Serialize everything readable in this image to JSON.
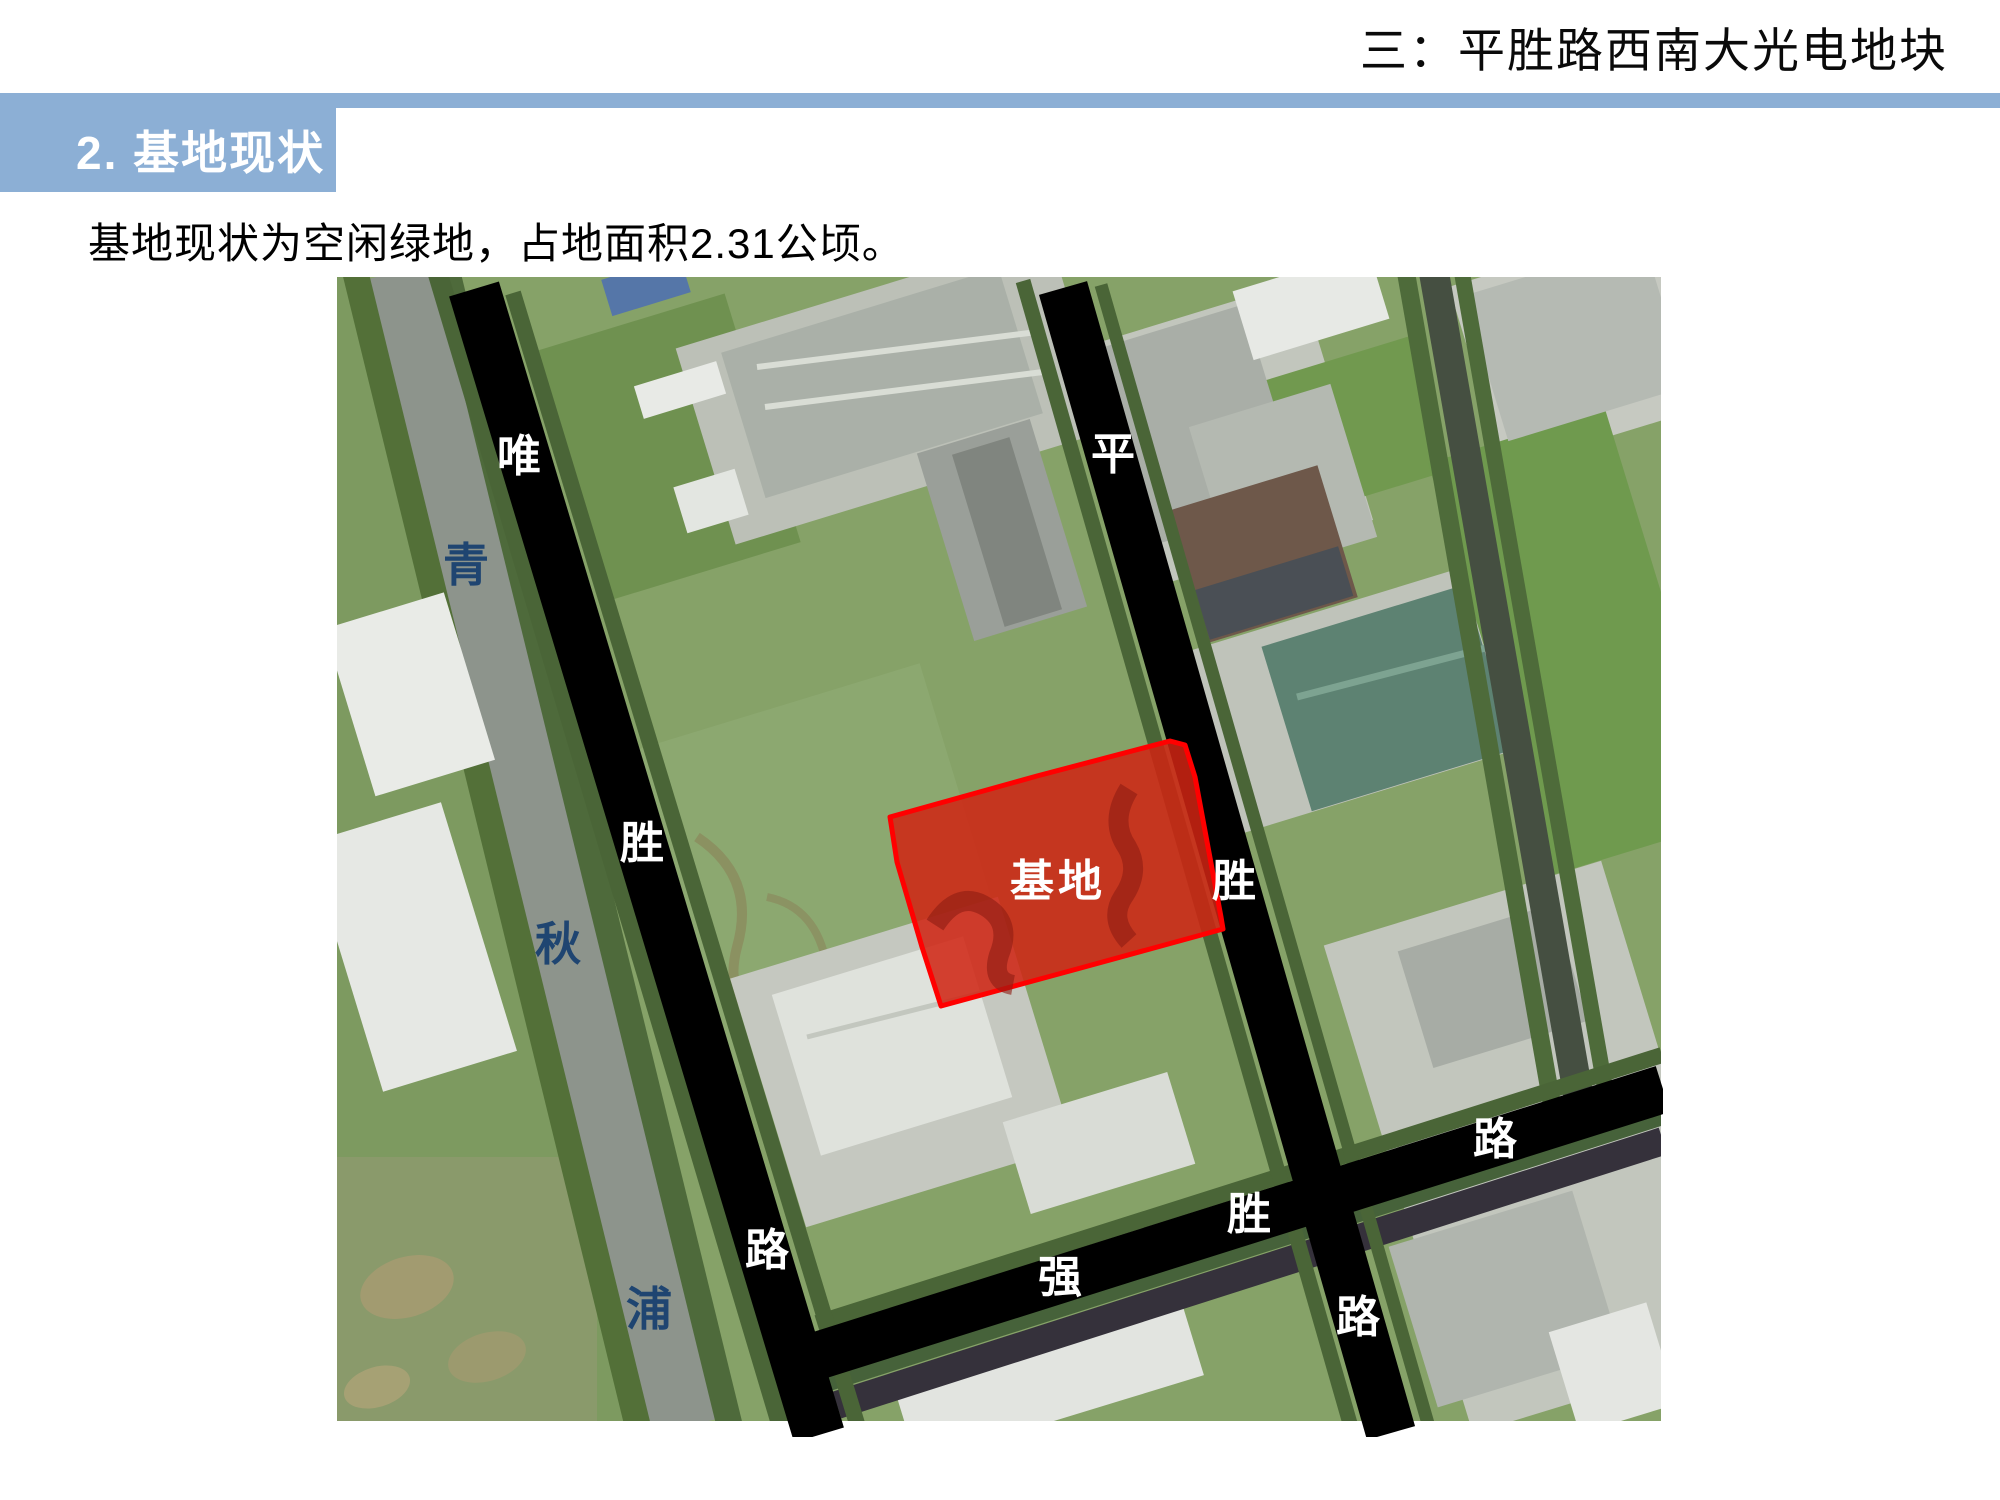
{
  "header": {
    "breadcrumb": "三：平胜路西南大光电地块"
  },
  "section": {
    "title": "2. 基地现状"
  },
  "body": {
    "text": "基地现状为空闲绿地，占地面积2.31公顷。"
  },
  "map": {
    "site_label": "基地",
    "river_chars": [
      "青",
      "秋",
      "浦"
    ],
    "roads": [
      {
        "name": "weisheng-road",
        "chars": [
          "唯",
          "胜",
          "路"
        ]
      },
      {
        "name": "pingsheng-road",
        "chars": [
          "平",
          "胜",
          "路"
        ]
      },
      {
        "name": "qiangsheng-road",
        "chars": [
          "强",
          "胜",
          "路"
        ]
      }
    ],
    "colors": {
      "road": "#000000",
      "site_fill": "#cf2413",
      "site_border": "#ff0000",
      "road_label": "#ffffff",
      "river_label": "#1f4571"
    }
  },
  "theme": {
    "banner_blue": "#8cafd5",
    "title_color": "#ffffff"
  }
}
